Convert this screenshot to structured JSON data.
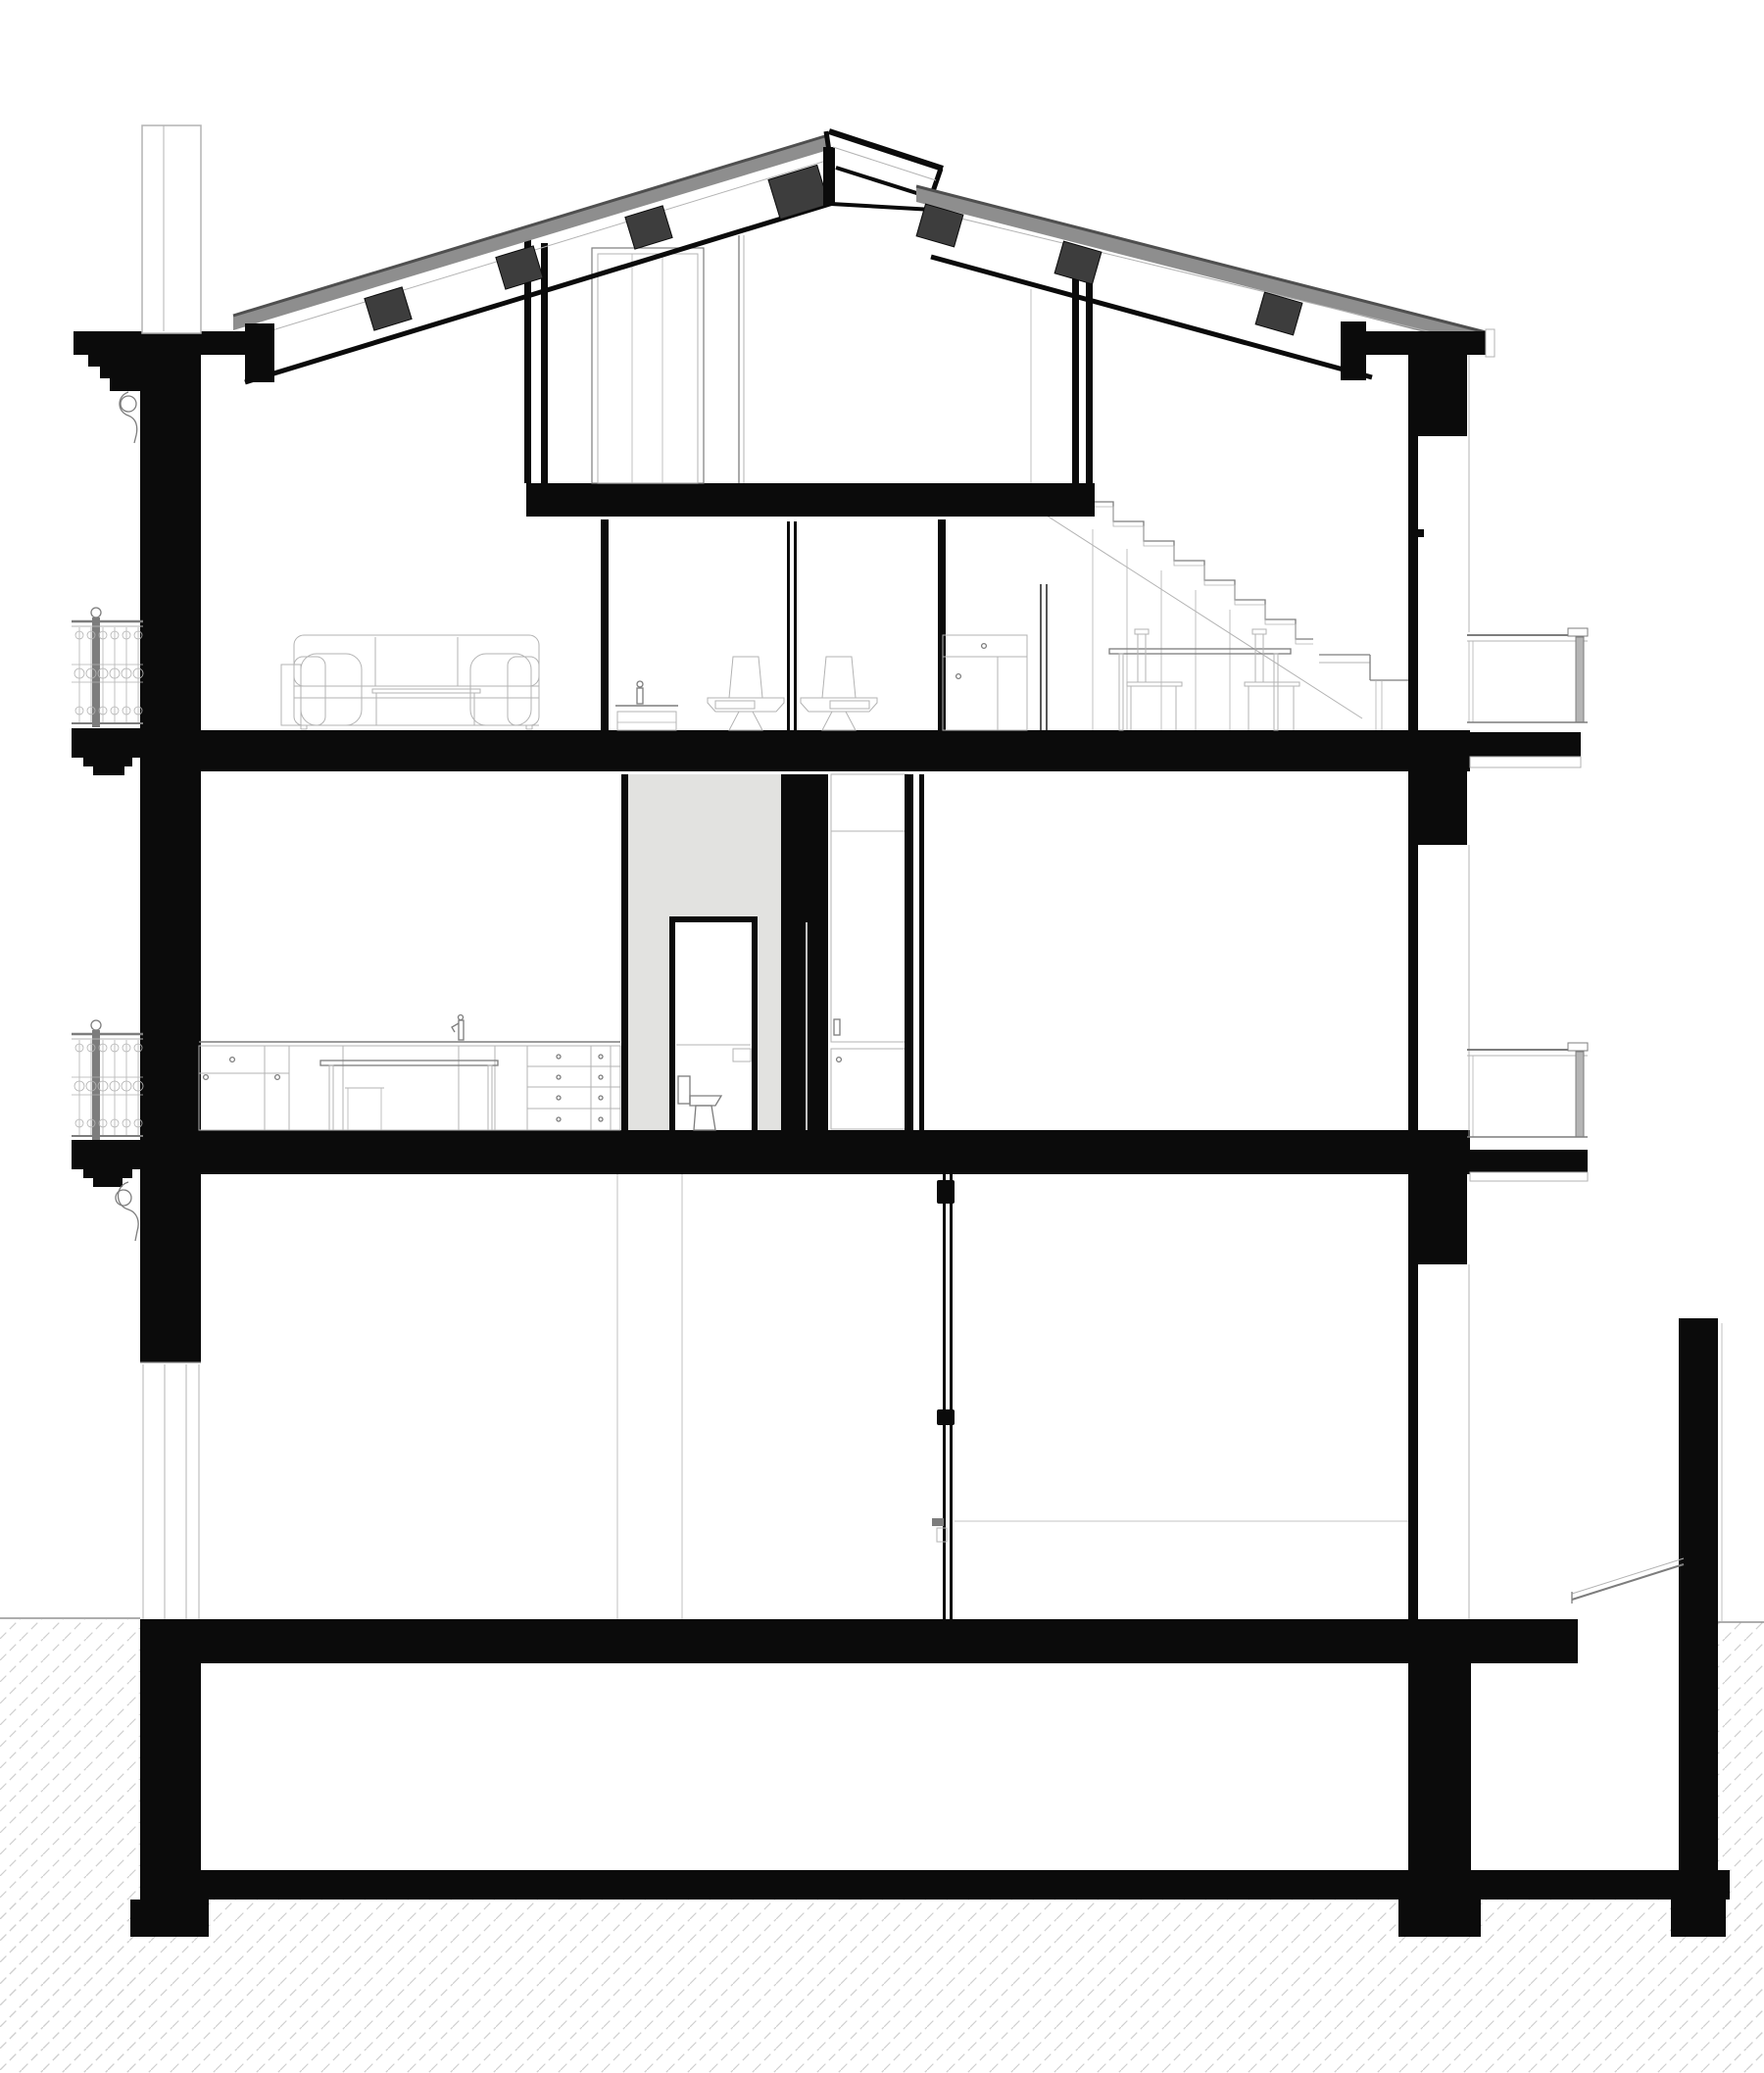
{
  "meta": {
    "label": "architectural cross-section drawing of a multi-storey house"
  },
  "colors": {
    "paper": "#ffffff",
    "ink": "#0b0b0b",
    "roofgray": "#8e8e8e",
    "roofedge": "#4f4f4f",
    "purlin": "#3d3d3d",
    "core": "#e2e2e0",
    "lite": "#b3b3b3",
    "mid": "#7d7d7d",
    "hatch": "#cfcfcf",
    "postgray": "#b5b5b5"
  }
}
